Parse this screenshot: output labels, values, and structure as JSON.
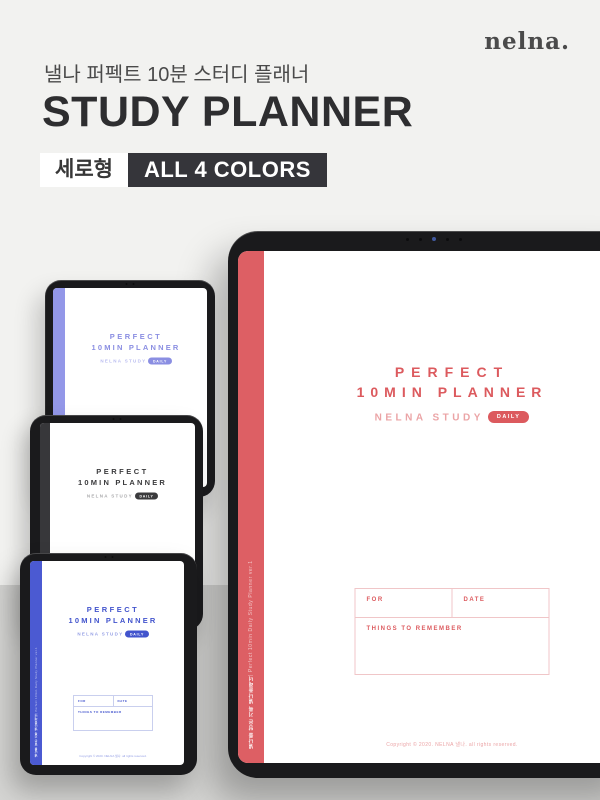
{
  "page": {
    "background_top": "#f2f2f0",
    "background_bottom": "#d5d5d3"
  },
  "header": {
    "logo": "nelna.",
    "subtitle": "낼나 퍼펙트 10분 스터디 플래너",
    "title": "STUDY PLANNER",
    "badges": [
      {
        "label": "세로형",
        "style": "light"
      },
      {
        "label": "ALL 4 COLORS",
        "style": "dark"
      }
    ]
  },
  "cover": {
    "title_line1": "PERFECT",
    "title_line2": "10MIN PLANNER",
    "brand": "NELNA STUDY",
    "badge": "DAILY",
    "form": {
      "for_label": "FOR",
      "date_label": "DATE",
      "remember_label": "THINGS TO REMEMBER"
    },
    "copyright": "Copyright © 2020. NELNA 낼나. all rights reserved.",
    "spine_ko": "낼나를 담은 기록 낼나플래너",
    "spine_en": "  |  Perfect 10min Daily Study Planner ver.1"
  },
  "variants": [
    {
      "name": "coral-red",
      "accent": "#dc5a5e",
      "accent_light": "#eba4a6",
      "spine": "#dd5f64",
      "table_border": "#f0c6c8"
    },
    {
      "name": "purple",
      "accent": "#8a8ee2",
      "accent_light": "#babdf0",
      "spine": "#9397e8"
    },
    {
      "name": "black",
      "accent": "#3b3b3d",
      "accent_light": "#aaaaac",
      "spine": "#37373a"
    },
    {
      "name": "blue",
      "accent": "#4254cd",
      "accent_light": "#96a0e5",
      "spine": "#4b5ad2",
      "table_border": "#c9cfee"
    }
  ]
}
